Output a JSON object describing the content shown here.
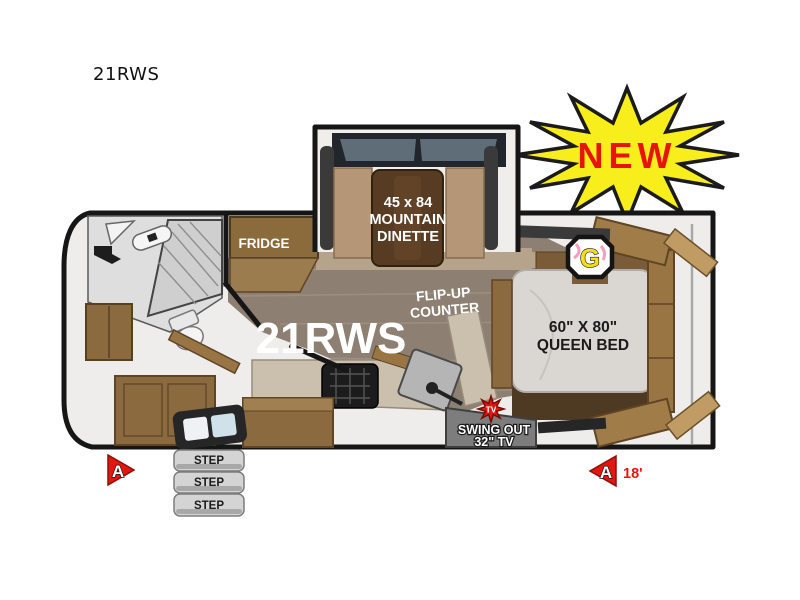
{
  "title": "21RWS",
  "new_badge": {
    "label": "NEW"
  },
  "plan": {
    "model": "21RWS",
    "dinette": {
      "line1": "45 x 84",
      "line2": "MOUNTAIN",
      "line3": "DINETTE"
    },
    "fridge": "FRIDGE",
    "flip_up": {
      "line1": "FLIP-UP",
      "line2": "COUNTER"
    },
    "bed": {
      "line1": "60\" X 80\"",
      "line2": "QUEEN BED"
    },
    "tv": {
      "badge": "TV",
      "line1": "SWING OUT",
      "line2": "32\" TV"
    },
    "logo": "G",
    "steps": [
      "STEP",
      "STEP",
      "STEP"
    ],
    "markers": {
      "door_side": "A",
      "rear_side": "A",
      "length": "18'"
    }
  },
  "colors": {
    "starburst": "#f8ee1b",
    "starburst_text": "#e8140c",
    "marker_red": "#e3170f",
    "wall": "#161616",
    "wood": "#9a7544",
    "wood_dark": "#573b22",
    "floor_wood": "#8d8072",
    "mattress": "#dad7d2"
  }
}
